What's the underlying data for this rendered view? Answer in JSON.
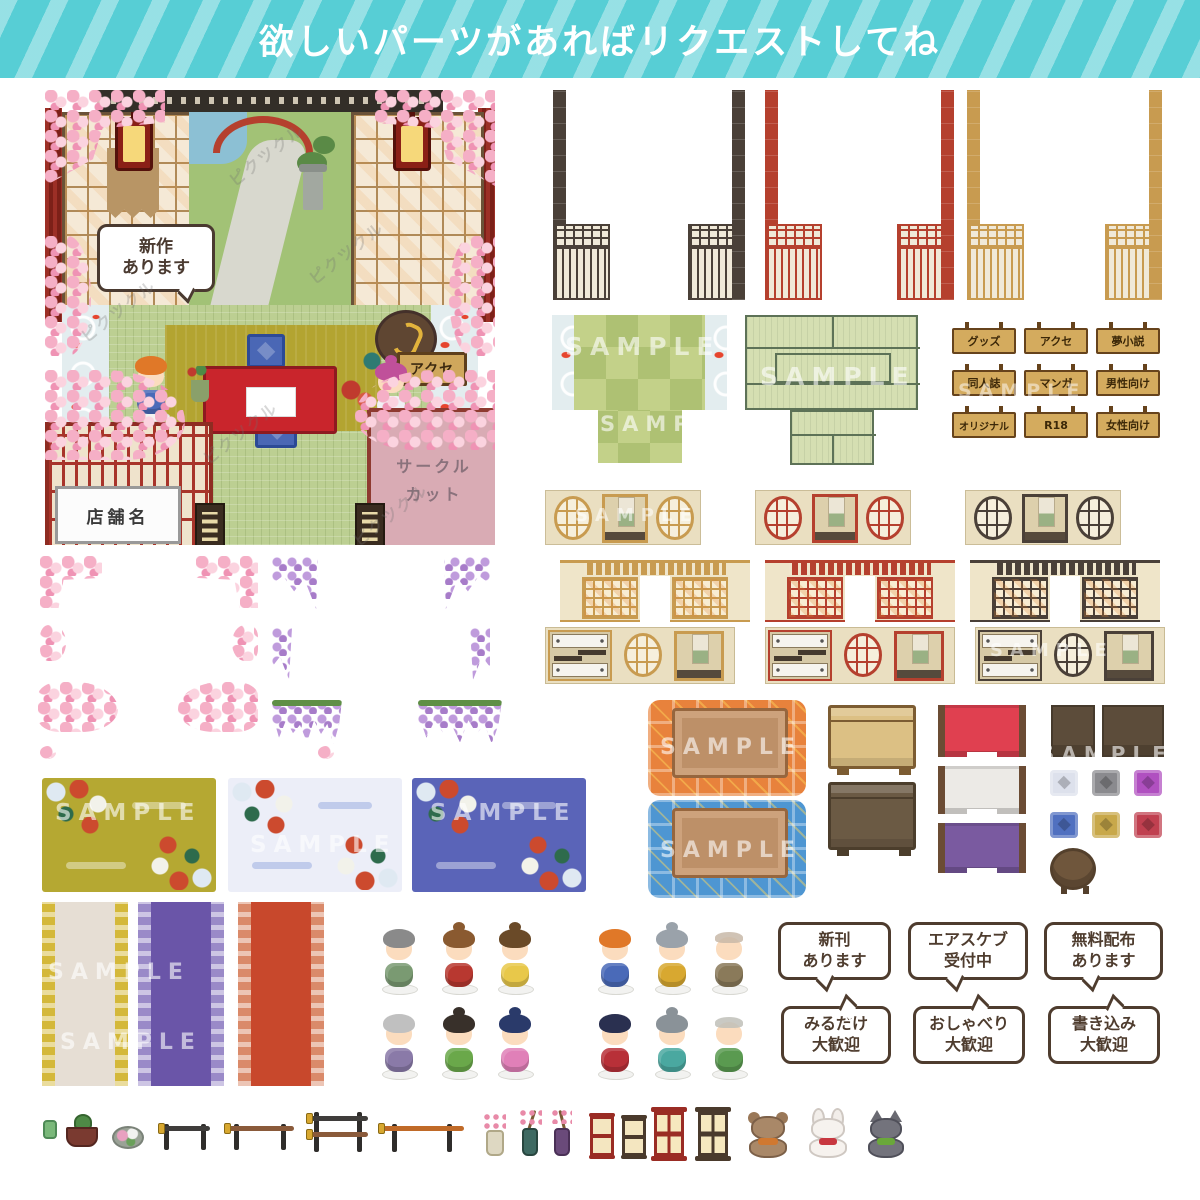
{
  "banner": {
    "text": "欲しいパーツがあればリクエストしてね",
    "bg": "#57ced5",
    "stripe": "#9ce2e5"
  },
  "watermark": {
    "sample": "SAMPLE",
    "brand": "ピクツクル"
  },
  "room": {
    "bubble_line1": "新作",
    "bubble_line2": "あります",
    "sign_accessories": "アクセ",
    "sign_goods": "グッズ",
    "shop_name_sign": "店舗名",
    "circle_cut_line1": "サークル",
    "circle_cut_line2": "カット"
  },
  "hanging_signs": {
    "items": [
      {
        "label": "グッズ"
      },
      {
        "label": "アクセ"
      },
      {
        "label": "夢小説"
      },
      {
        "label": "同人誌"
      },
      {
        "label": "マンガ"
      },
      {
        "label": "男性向け"
      },
      {
        "label": "オリジナル"
      },
      {
        "label": "R18"
      },
      {
        "label": "女性向け"
      }
    ]
  },
  "speech_bubbles": {
    "top": [
      {
        "line1": "新刊",
        "line2": "あります"
      },
      {
        "line1": "エアスケブ",
        "line2": "受付中"
      },
      {
        "line1": "無料配布",
        "line2": "あります"
      }
    ],
    "bottom": [
      {
        "line1": "みるだけ",
        "line2": "大歓迎"
      },
      {
        "line1": "おしゃべり",
        "line2": "大歓迎"
      },
      {
        "line1": "書き込み",
        "line2": "大歓迎"
      }
    ]
  },
  "palette": {
    "banner_teal": "#57ced5",
    "pillar_dark": "#4a4038",
    "pillar_red": "#b5402e",
    "pillar_tan": "#c89b50",
    "wall_cream": "#eadfc1",
    "tatami_green": "#c3d189",
    "tatami_bordered": "#d5dfb2",
    "kotatsu_orange": "#e8823c",
    "kotatsu_blue": "#4e96d2",
    "rug_gold": "#b5a832",
    "rug_white": "#eceef8",
    "rug_blue": "#5a64b8",
    "runner_cream": "#e6ded2",
    "runner_purple": "#6a55a8",
    "runner_red": "#c8482c",
    "sign_wood": "#d4ab5e",
    "sakura_pink": "#f5afc6",
    "wisteria_purple": "#a77cc9"
  },
  "walls": {
    "rows": [
      "round-window-scroll-wall",
      "doorway-shoji-wall",
      "shelf-window-scroll-wall"
    ],
    "colors": [
      "gold",
      "red",
      "dark-brown"
    ],
    "pillars": [
      "dark-pillar-left",
      "dark-pillar-right",
      "red-pillar-left",
      "red-pillar-right",
      "tan-pillar-left",
      "tan-pillar-right"
    ]
  },
  "floors": {
    "items": [
      "tatami-koi-pond-checkered",
      "tatami-green-bordered"
    ]
  },
  "furniture": {
    "items": [
      "kotatsu-orange",
      "kotatsu-blue",
      "chest-tan",
      "chest-brown",
      "screen-red",
      "screen-white",
      "screen-purple",
      "counter-small",
      "counter-wide",
      "zabuton-white",
      "zabuton-gray",
      "zabuton-purple",
      "zabuton-blue",
      "zabuton-gold",
      "zabuton-red",
      "round-table"
    ]
  },
  "decor": {
    "items": [
      "sakura-corner-left",
      "sakura-corner-right",
      "sakura-side-left",
      "sakura-side-right",
      "sakura-branch-left",
      "sakura-branch-right",
      "wisteria-corner-left",
      "wisteria-corner-right",
      "wisteria-side-left",
      "wisteria-side-right",
      "wisteria-garland-left",
      "wisteria-garland-right"
    ]
  },
  "characters": {
    "row1": [
      "grandma-green-kimono",
      "woman-red-kimono",
      "girl-yellow-kimono",
      "boy-blue-kimono",
      "man-mustard-kimono",
      "elder-brown-kimono"
    ],
    "row2": [
      "grandma-purple-kimono",
      "woman-green-kimono",
      "girl-pink-kimono",
      "boy-red-kimono",
      "man-teal-kimono",
      "elder-green-kimono"
    ]
  },
  "small_items": {
    "items": [
      "teacup",
      "bonsai-pot",
      "temari-ball",
      "sword-stand-black",
      "sword-stand-brown",
      "sword-stand-double",
      "naginata-stand",
      "ikebana-white-vase",
      "ikebana-teal-vase",
      "ikebana-purple-vase",
      "andon-red",
      "andon-brown",
      "lantern-red",
      "lantern-brown",
      "bear-plush",
      "rabbit-plush",
      "cat-plush"
    ]
  }
}
